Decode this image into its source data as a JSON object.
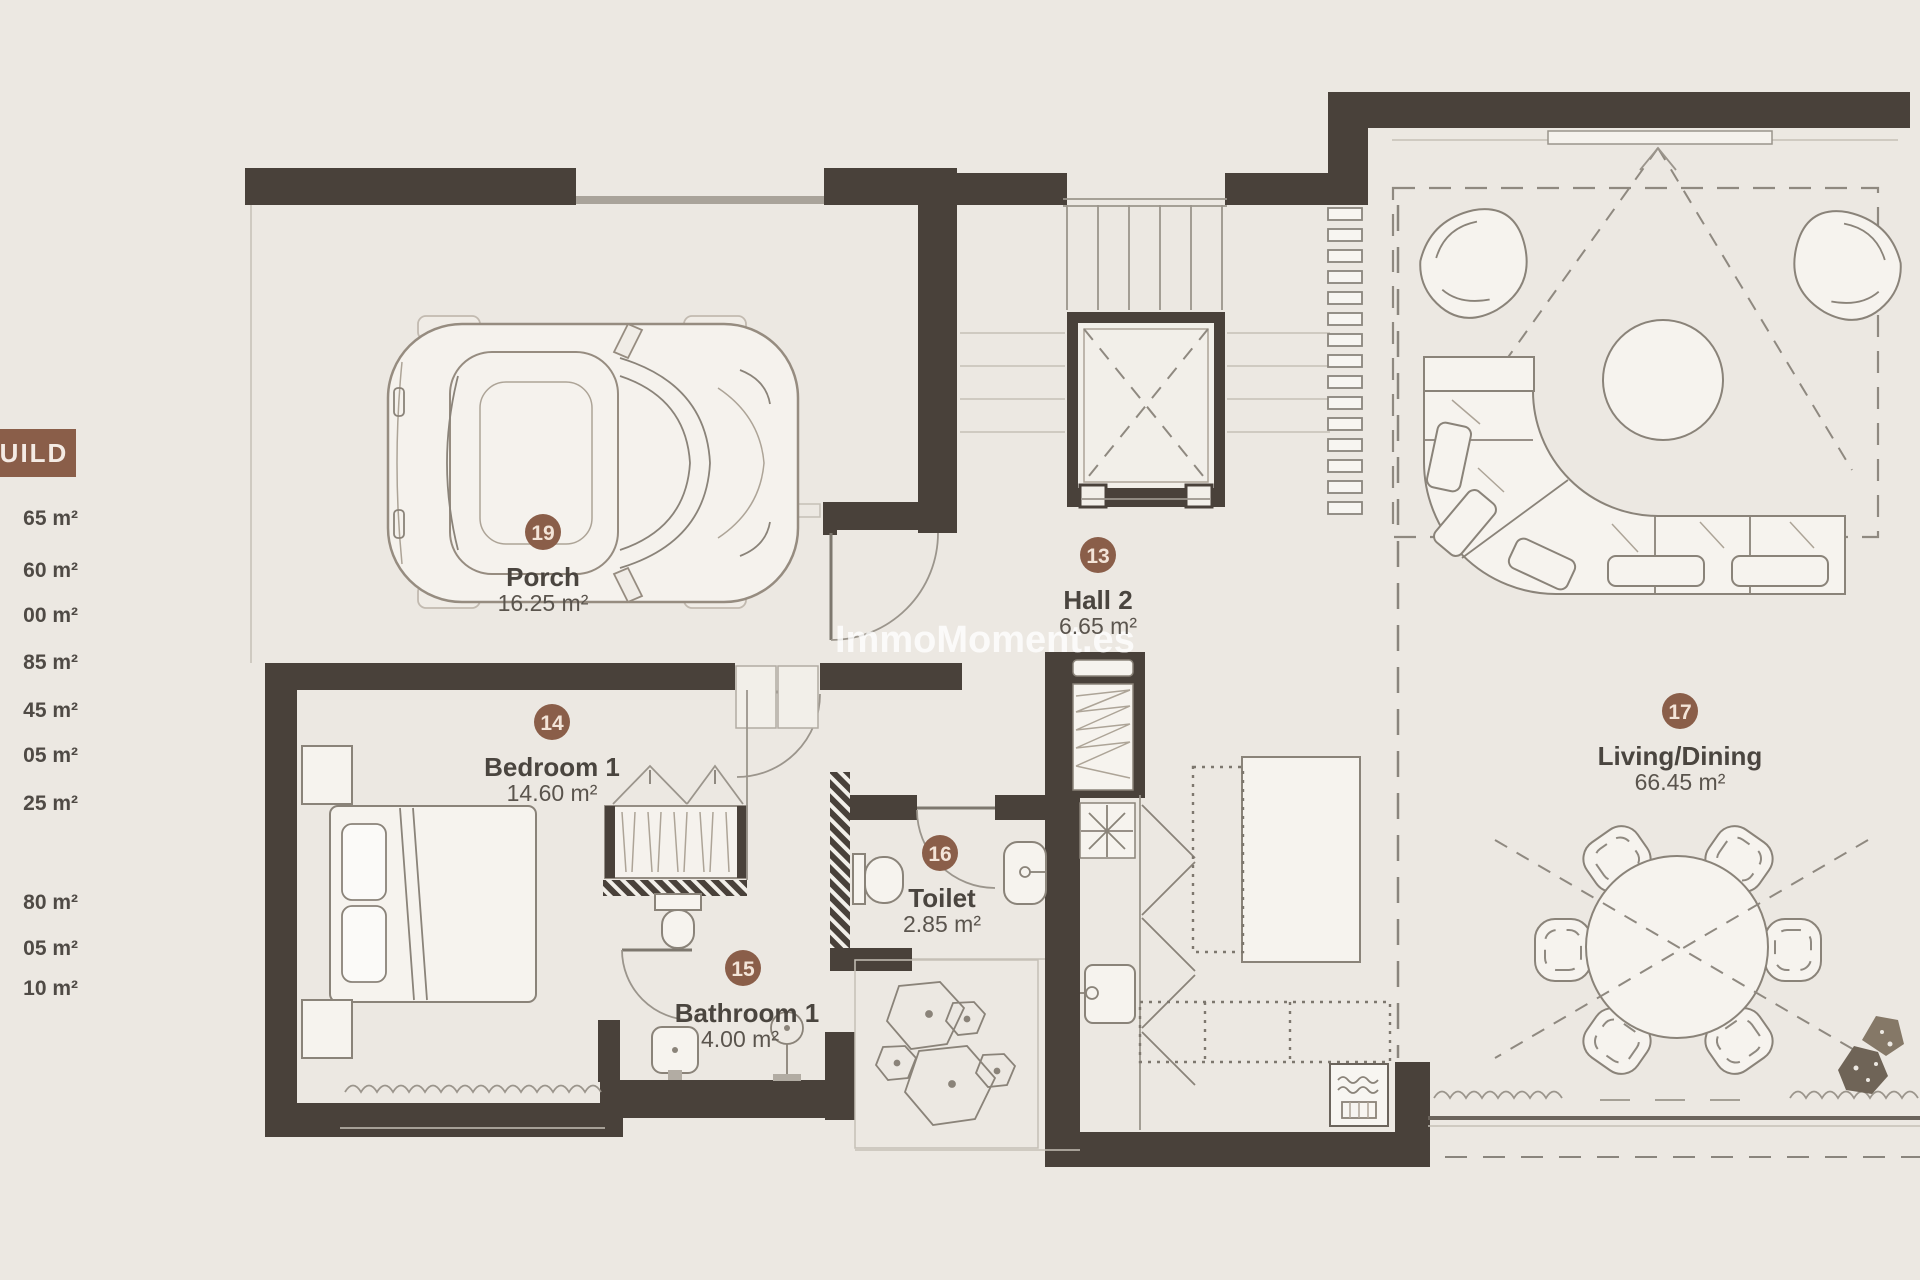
{
  "legend": {
    "header": "UILD",
    "items": [
      "65 m²",
      "60 m²",
      "00 m²",
      "85 m²",
      "45 m²",
      "05 m²",
      "25 m²",
      "80 m²",
      "05 m²",
      "10 m²"
    ]
  },
  "rooms": [
    {
      "number": "19",
      "name": "Porch",
      "area": "16.25 m²"
    },
    {
      "number": "13",
      "name": "Hall 2",
      "area": "6.65 m²"
    },
    {
      "number": "14",
      "name": "Bedroom 1",
      "area": "14.60 m²"
    },
    {
      "number": "15",
      "name": "Bathroom 1",
      "area": "4.00 m²"
    },
    {
      "number": "16",
      "name": "Toilet",
      "area": "2.85 m²"
    },
    {
      "number": "17",
      "name": "Living/Dining",
      "area": "66.45 m²"
    }
  ],
  "watermark": {
    "text": "ImmoMoment.es"
  },
  "colors": {
    "background": "#ECE8E2",
    "wall": "#49413A",
    "badge": "#8A5E49",
    "legend_box": "#8A5E49",
    "room_text": "#4A453F"
  }
}
